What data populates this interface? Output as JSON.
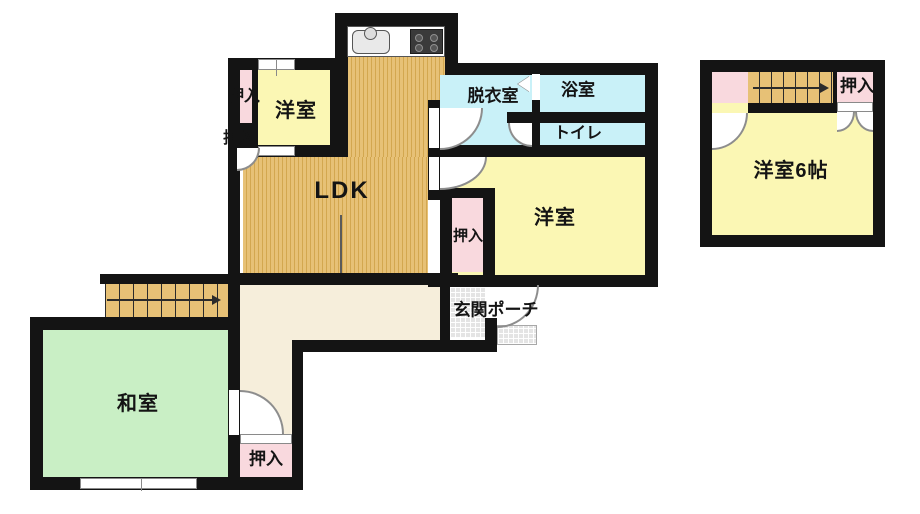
{
  "floor1": {
    "ldk": "LDK",
    "youshitsu_top": "洋室",
    "oshiire_top_1": "押入",
    "oshiire_top_2": "押入",
    "datsuishitsu": "脱衣室",
    "yokushitsu": "浴室",
    "toire": "トイレ",
    "youshitsu_right": "洋室",
    "oshiire_mid": "押入",
    "washitsu": "和室",
    "oshiire_bottom": "押入",
    "genkan_porch": "玄関ポーチ"
  },
  "floor2": {
    "youshitsu_6jo": "洋室6帖",
    "oshiire": "押入"
  },
  "colors": {
    "wall": "#141414",
    "wood_floor": "#e7c176",
    "wood_stripe": "#d3a74f",
    "western_room": "#fbf7b4",
    "japanese_room": "#c9efc5",
    "wet_area": "#c9f1f8",
    "closet": "#f9d9de",
    "hallway": "#f6eedb",
    "entrance_tile": "#e4e4e4",
    "background": "#ffffff"
  }
}
